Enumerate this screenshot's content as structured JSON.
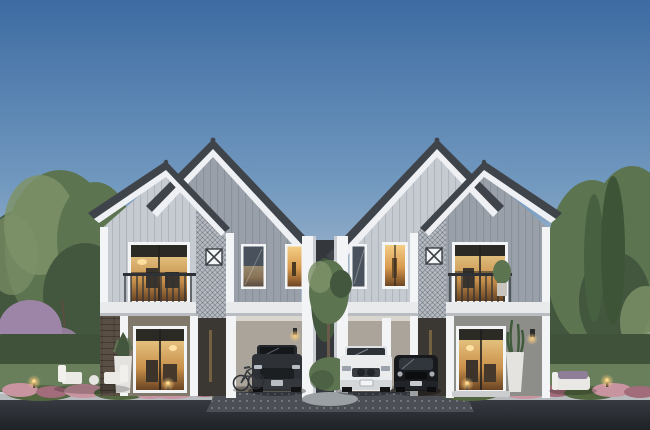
{
  "scene": {
    "setting": "dusk photorealistic architectural rendering, front elevation",
    "subject": "two modern two-storey gabled houses side by side with carports and landscaped garden",
    "houses": [
      {
        "id": "left-house",
        "storeys": 2,
        "features": [
          "double gable roof with dark trim and white fascia",
          "light grey vertical siding",
          "diagonal lattice mesh gable screen with small ornament window",
          "balcony with dark metal railing and warm-lit sliding window",
          "two upper windows (one warm-lit)",
          "warm-lit glass sliding door",
          "single-bay carport",
          "white potted plant by door"
        ]
      },
      {
        "id": "right-house",
        "storeys": 2,
        "features": [
          "double gable roof with dark trim and white fascia",
          "light grey vertical siding",
          "diagonal lattice mesh gable screen with small ornament window",
          "balcony with railing and potted plant",
          "two upper windows (one warm-lit)",
          "warm-lit glass sliding door",
          "two-bay carport with centre column",
          "tall white potted plant by door"
        ]
      }
    ],
    "vehicles": [
      {
        "id": "suv-dark",
        "type": "suv",
        "color": "dark grey",
        "location": "left house carport"
      },
      {
        "id": "suv-white",
        "type": "suv",
        "color": "white",
        "location": "right house carport, left bay"
      },
      {
        "id": "car-black",
        "type": "compact car",
        "color": "black",
        "location": "right house carport, right bay"
      },
      {
        "id": "bicycle",
        "type": "bicycle",
        "location": "leaning beside left carport column"
      }
    ],
    "landscape": [
      "leafy green trees on the left",
      "purple flowering shrubs",
      "tall conifers on the right",
      "trimmed hedge walls both sides",
      "lawn strips",
      "pink flower beds along the kerb",
      "round topiary bush and small tree on centre island",
      "garden bollard lights glowing warm"
    ],
    "furniture": [
      "two white sun loungers with small round table on left lawn",
      "white garden bench with purple cushion on right lawn"
    ],
    "ground": [
      "dark dotted-paver driveway aprons",
      "light concrete kerb",
      "dark asphalt road in foreground"
    ]
  },
  "colors": {
    "sky-top": "#3d6ba2",
    "sky-mid": "#7299bf",
    "sky-low": "#b3c1d2",
    "sky-horizon": "#d9ced2",
    "dusk-pink": "#ecd3d0",
    "roof-dark": "#3f434a",
    "fascia-white": "#eef0f3",
    "trim-white": "#f2f4f6",
    "band-white": "#e8eaec",
    "siding-light": "#c6cbd2",
    "siding-mid": "#99a0a9",
    "mesh-gray": "#b7bcc3",
    "wall-taupe": "#81786c",
    "brick-dark": "#594f45",
    "wall-gray": "#8d8d8a",
    "carport-wall": "#aaa49b",
    "gap-dark": "#34383c",
    "slot-dark": "#3b3732",
    "glass-dark": "#2c2a25",
    "window-warm": "#e2b066",
    "window-dark": "#49525c",
    "railing": "#2e3236",
    "tree-green": "#5d7451",
    "tree-dark": "#43563e",
    "tree-light": "#7e9268",
    "conifer": "#466040",
    "purple-bloom": "#9d85a8",
    "hedge": "#40533a",
    "grass": "#697e5b",
    "flower-pink": "#c794a0",
    "flower-deep": "#a26c7a",
    "flower-leaf": "#52663f",
    "driveway": "#4c5056",
    "kerb": "#b8bbbe",
    "road": "#383c42",
    "road-dark": "#1e2126",
    "car-dark": "#2e3136",
    "car-white": "#eaecee",
    "car-black": "#17191c",
    "planter-white": "#e4e3e0",
    "light-warm": "#ffc978",
    "step-white": "#cbcdce"
  }
}
